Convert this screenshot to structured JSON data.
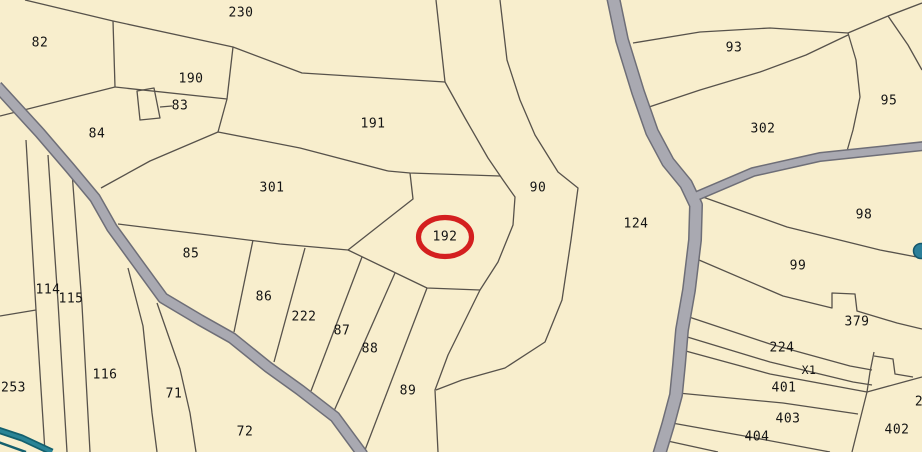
{
  "map": {
    "type": "cadastral-parcel-map",
    "background_color": "#f8eecd",
    "boundary_color": "#57524b",
    "road_fill_color": "#a9a9b1",
    "road_edge_color": "#6e6e77",
    "water_color": "#2a8496",
    "label_color": "#141414",
    "highlight": {
      "parcel": "192",
      "color": "#d41f1f",
      "cx": 445,
      "cy": 237,
      "rx": 26.5,
      "ry": 19.5
    }
  },
  "parcels": [
    {
      "label": "230",
      "x": 241,
      "y": 13
    },
    {
      "label": "82",
      "x": 40,
      "y": 43
    },
    {
      "label": "190",
      "x": 191,
      "y": 79
    },
    {
      "label": "83",
      "x": 180,
      "y": 106
    },
    {
      "label": "84",
      "x": 97,
      "y": 134
    },
    {
      "label": "191",
      "x": 373,
      "y": 124
    },
    {
      "label": "93",
      "x": 734,
      "y": 48
    },
    {
      "label": "302",
      "x": 763,
      "y": 129
    },
    {
      "label": "95",
      "x": 889,
      "y": 101
    },
    {
      "label": "301",
      "x": 272,
      "y": 188
    },
    {
      "label": "90",
      "x": 538,
      "y": 188
    },
    {
      "label": "192",
      "x": 445,
      "y": 237
    },
    {
      "label": "124",
      "x": 636,
      "y": 224
    },
    {
      "label": "98",
      "x": 864,
      "y": 215
    },
    {
      "label": "99",
      "x": 798,
      "y": 266
    },
    {
      "label": "85",
      "x": 191,
      "y": 254
    },
    {
      "label": "114",
      "x": 48,
      "y": 290
    },
    {
      "label": "115",
      "x": 71,
      "y": 299
    },
    {
      "label": "86",
      "x": 264,
      "y": 297
    },
    {
      "label": "222",
      "x": 304,
      "y": 317
    },
    {
      "label": "87",
      "x": 342,
      "y": 331
    },
    {
      "label": "88",
      "x": 370,
      "y": 349
    },
    {
      "label": "379",
      "x": 857,
      "y": 322
    },
    {
      "label": "224",
      "x": 782,
      "y": 348
    },
    {
      "label": "X1",
      "x": 809,
      "y": 370,
      "small": true
    },
    {
      "label": "401",
      "x": 784,
      "y": 388
    },
    {
      "label": "116",
      "x": 105,
      "y": 375
    },
    {
      "label": "253",
      "x": 1,
      "y": 388,
      "anchor": "start"
    },
    {
      "label": "71",
      "x": 174,
      "y": 394
    },
    {
      "label": "89",
      "x": 408,
      "y": 391
    },
    {
      "label": "403",
      "x": 788,
      "y": 419
    },
    {
      "label": "404",
      "x": 757,
      "y": 437
    },
    {
      "label": "402",
      "x": 897,
      "y": 430
    },
    {
      "label": "72",
      "x": 245,
      "y": 432
    },
    {
      "label": "2",
      "x": 919,
      "y": 402
    }
  ]
}
